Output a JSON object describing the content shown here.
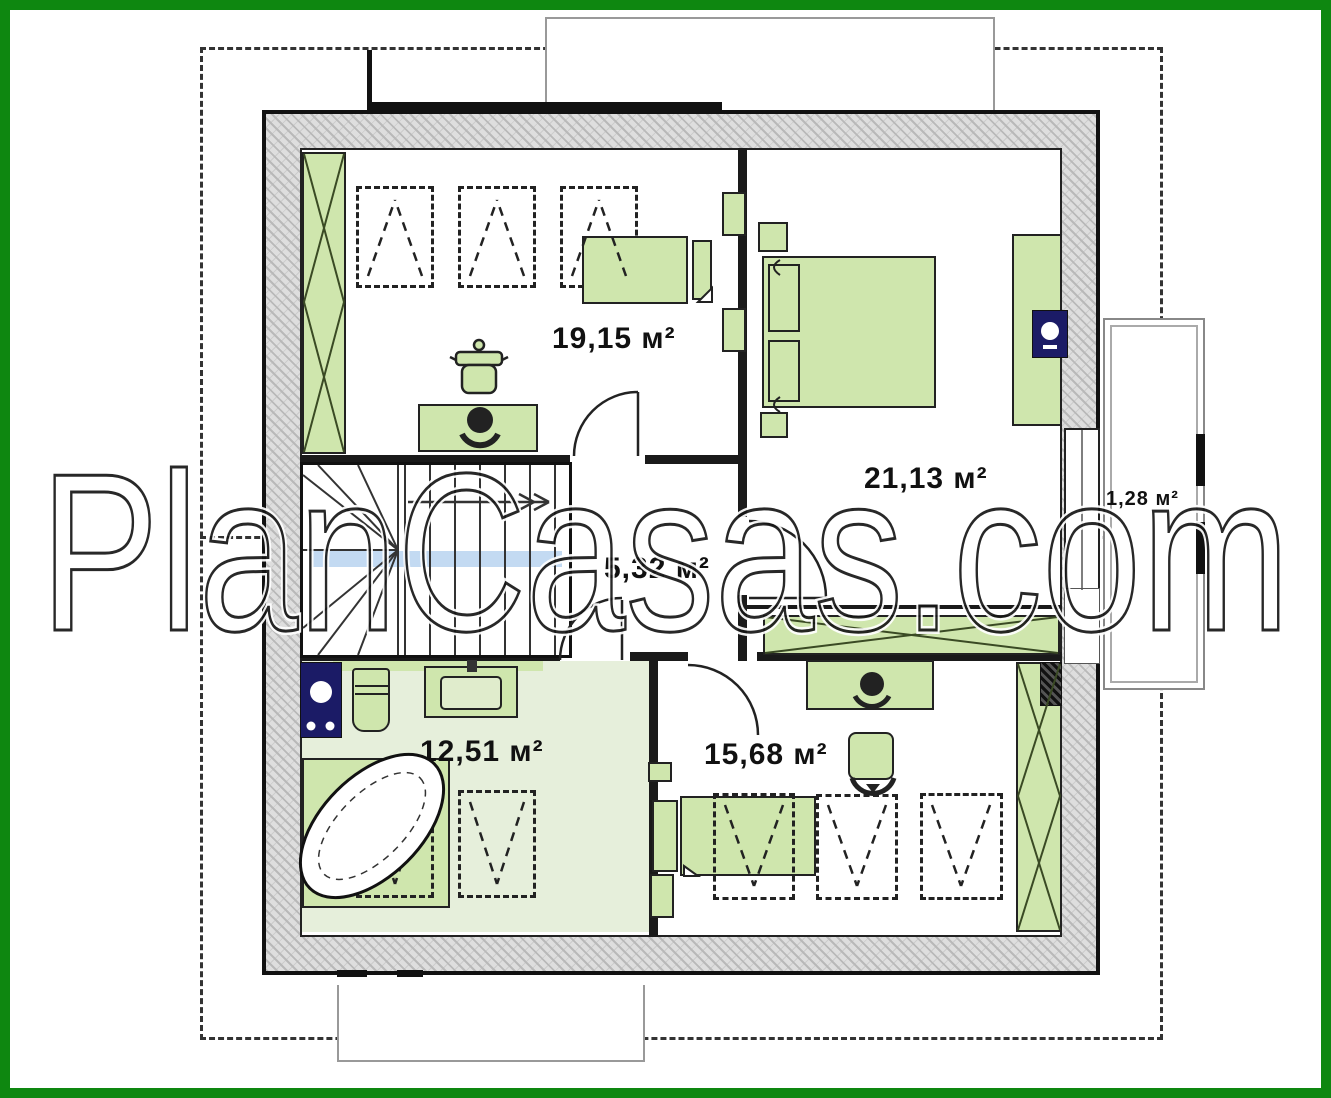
{
  "watermark": {
    "text": "PlanCasas.com"
  },
  "rooms": [
    {
      "name": "bedroom-top-left",
      "area": "19,15 м²"
    },
    {
      "name": "bedroom-top-right",
      "area": "21,13 м²"
    },
    {
      "name": "hallway",
      "area": "5,32 м²"
    },
    {
      "name": "bathroom",
      "area": "12,51 м²"
    },
    {
      "name": "bedroom-bottom-right",
      "area": "15,68 м²"
    },
    {
      "name": "balcony",
      "area": "1,28 м²"
    }
  ],
  "colors": {
    "frame_green": "#0E8710",
    "furniture_green": "#cfe6ad",
    "bathroom_floor": "#e6efdb",
    "appliance_navy": "#1b1b66",
    "stairs_highlight_blue": "#b9d3f0",
    "wall_hatch_gray": "#dedede",
    "line_black": "#1a1a1a"
  },
  "icons": [
    "wardrobe-x-icon",
    "skylight-dashed-icon",
    "bed-icon",
    "double-bed-icon",
    "desk-icon",
    "desk-chair-icon",
    "plant-pot-icon",
    "tv-icon",
    "washing-machine-icon",
    "toilet-icon",
    "washbasin-icon",
    "corner-bathtub-icon",
    "winder-stairs-icon",
    "door-swing-icon",
    "balcony-railing-icon"
  ]
}
